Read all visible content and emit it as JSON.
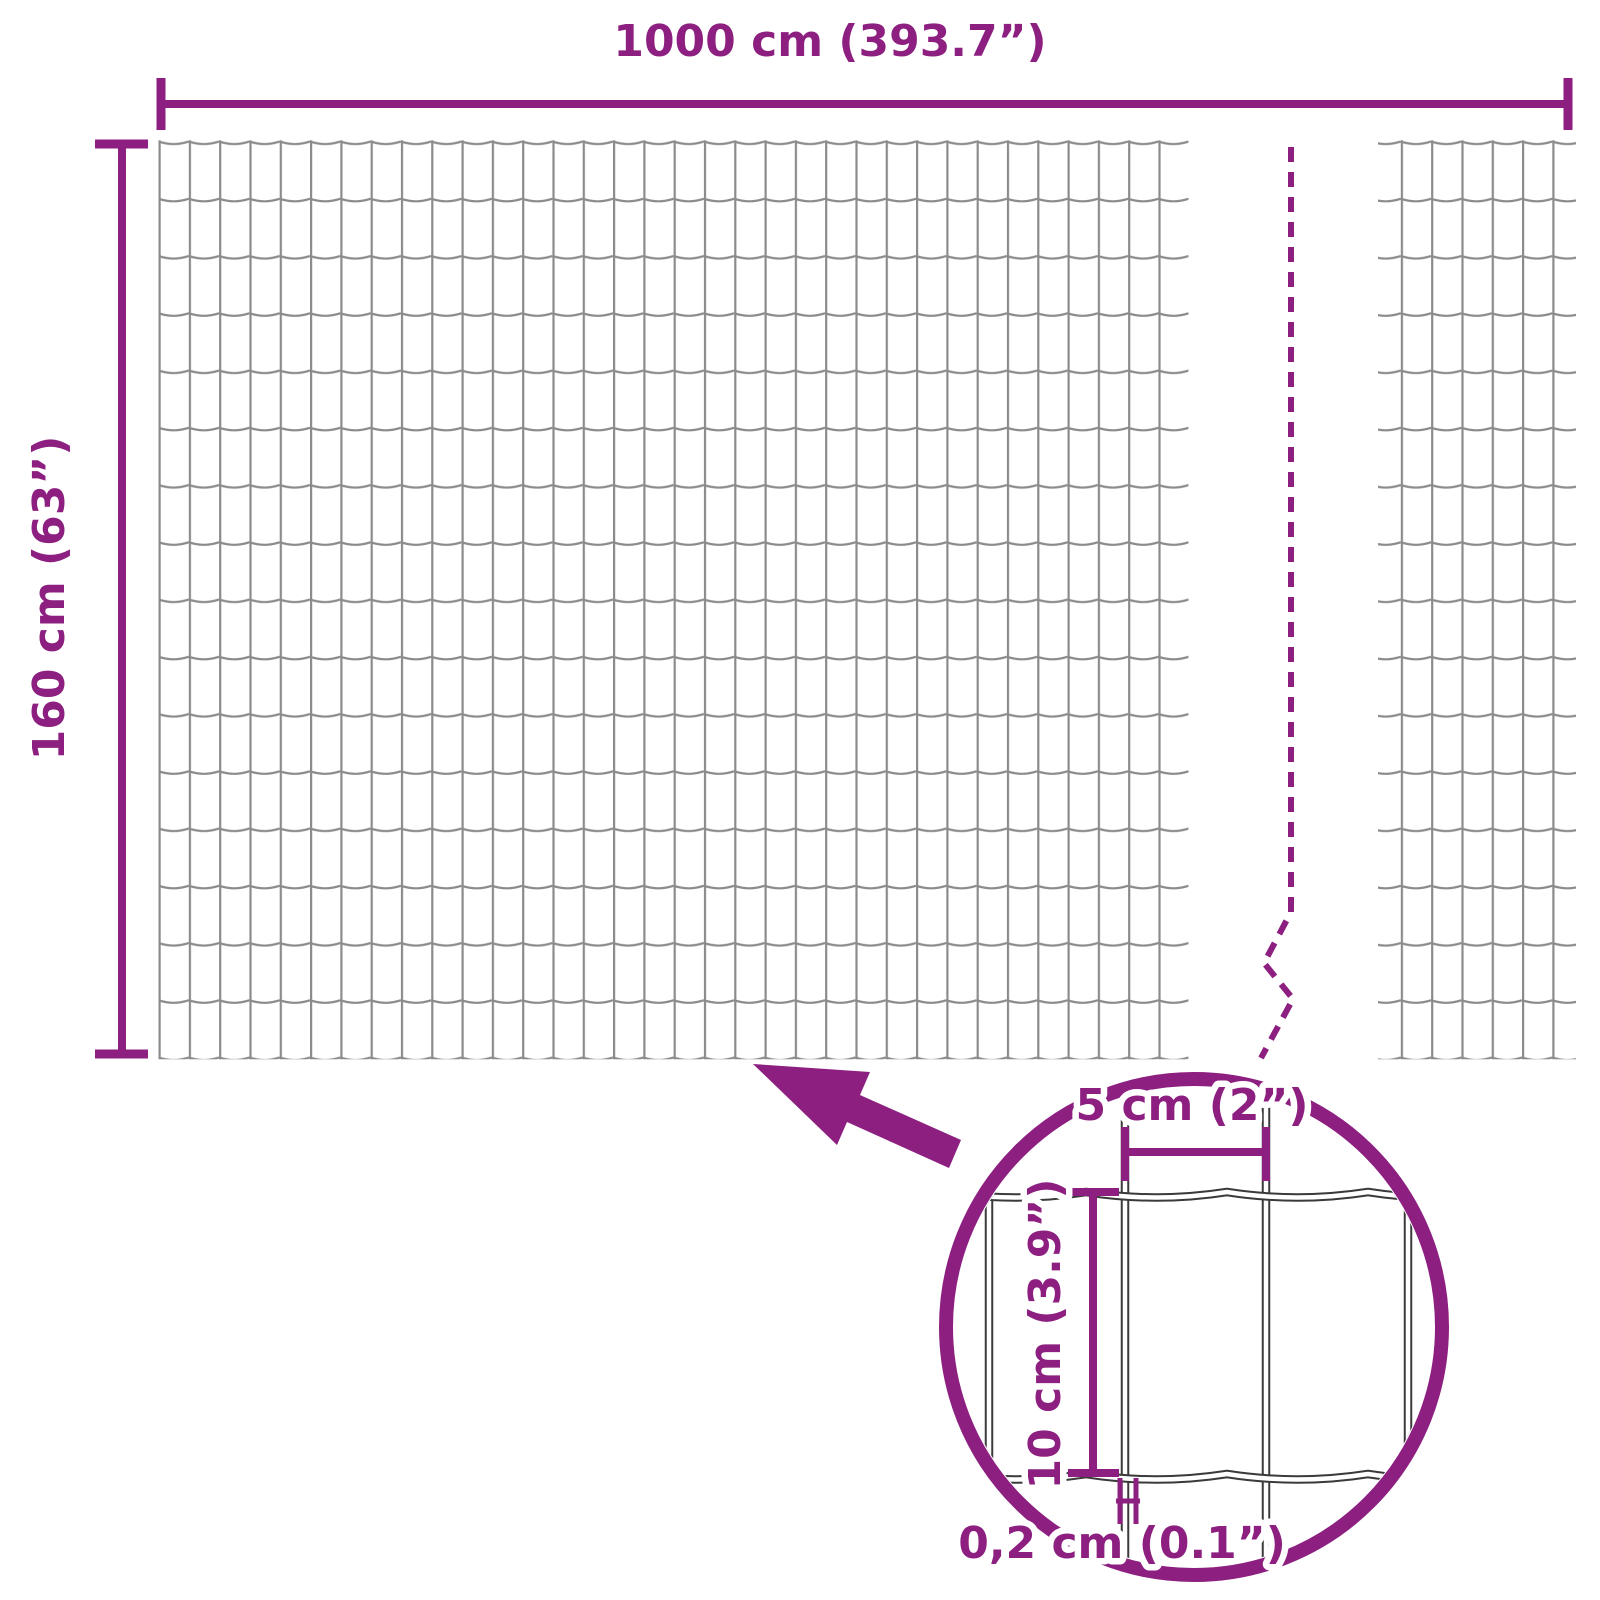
{
  "diagram": {
    "kind": "product-dimension-diagram",
    "subject": "garden wire mesh fence panel",
    "background_color": "#FFFFFF",
    "accent_color": "#8C1F80",
    "mesh_wire_color": "#8B8B8B",
    "lens_wire_color": "#3A3A3A",
    "dimensions": {
      "total_width": {
        "label": "1000 cm (393.7”)",
        "cm": 1000,
        "inches": 393.7
      },
      "total_height": {
        "label": "160 cm (63”)",
        "cm": 160,
        "inches": 63
      },
      "cell_width": {
        "label": "5 cm (2”)",
        "cm": 5,
        "inches": 2
      },
      "cell_height": {
        "label": "10 cm (3.9”)",
        "cm": 10,
        "inches": 3.9
      },
      "wire_thickness": {
        "label": "0,2 cm (0.1”)",
        "cm": 0.2,
        "inches": 0.1
      }
    }
  }
}
